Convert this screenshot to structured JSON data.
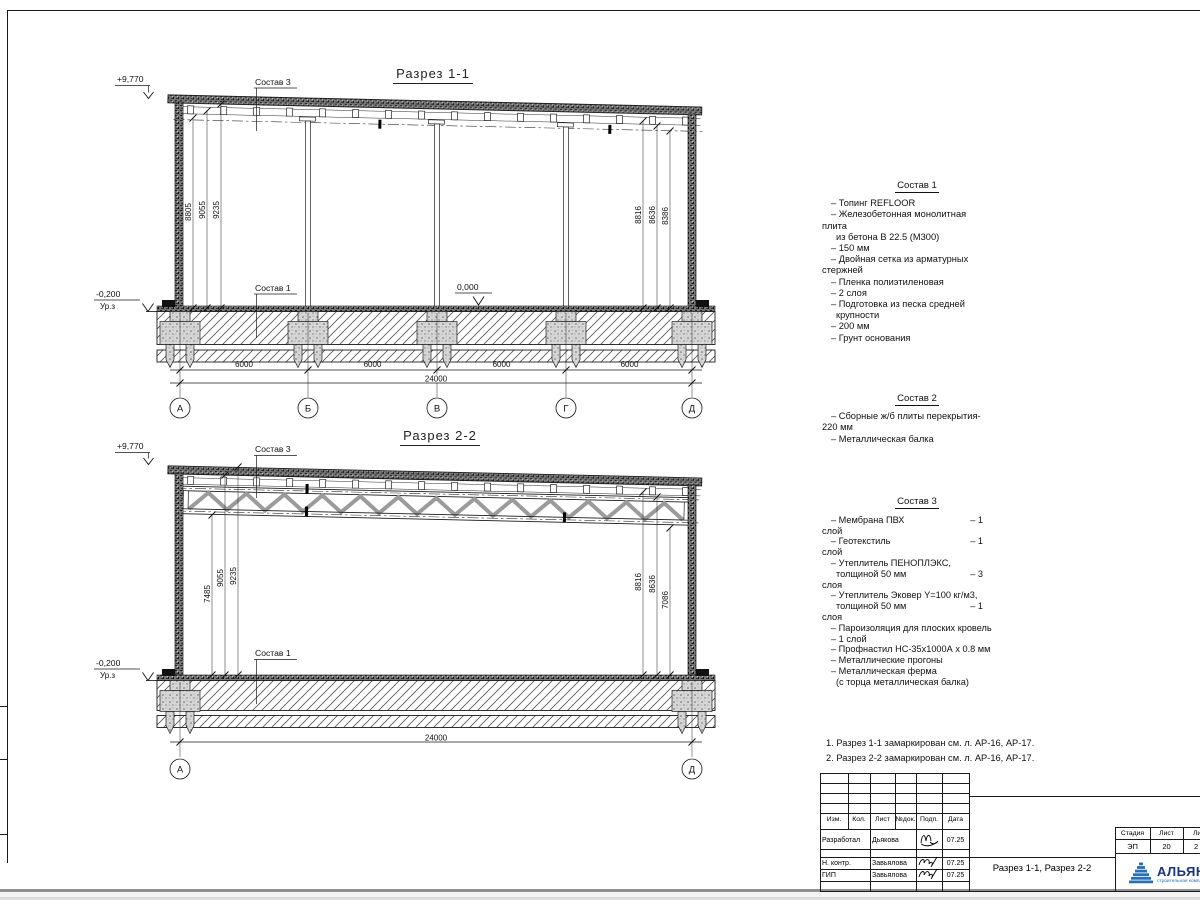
{
  "sections": {
    "s1": {
      "title": "Разрез 1-1",
      "elev_top": "+9,770",
      "elev_zero": "0,000",
      "elev_ground": "-0,200",
      "ground_label": "Ур.з",
      "leader_roof": "Состав 3",
      "leader_floor": "Состав 1",
      "dims_left": [
        "8805",
        "9055",
        "9235"
      ],
      "dims_right": [
        "8816",
        "8636",
        "8386"
      ],
      "dims_span": [
        "6000",
        "6000",
        "6000",
        "6000"
      ],
      "dim_total": "24000",
      "axes": [
        "А",
        "Б",
        "В",
        "Г",
        "Д"
      ]
    },
    "s2": {
      "title": "Разрез 2-2",
      "elev_top": "+9,770",
      "elev_ground": "-0,200",
      "ground_label": "Ур.з",
      "leader_roof": "Состав 3",
      "leader_floor": "Состав 1",
      "dims_left": [
        "7485",
        "9055",
        "9235"
      ],
      "dims_right": [
        "8816",
        "8636",
        "7086"
      ],
      "dim_total": "24000",
      "axes": [
        "А",
        "Д"
      ]
    }
  },
  "compositions": [
    {
      "title": "Состав 1",
      "lines": [
        {
          "t": "– Топинг REFLOOR"
        },
        {
          "t": "– Железобетонная  монолитная"
        },
        {
          "t": "плита",
          "i": "c"
        },
        {
          "t": "из бетона В 22.5 (М300)",
          "i": "d"
        },
        {
          "t": "– 150 мм"
        },
        {
          "t": "– Двойная сетка из арматурных"
        },
        {
          "t": "стержней",
          "i": "c"
        },
        {
          "t": "– Пленка полиэтиленовая"
        },
        {
          "t": "–  2 слоя"
        },
        {
          "t": "– Подготовка из песка средней"
        },
        {
          "t": "крупности",
          "i": "d"
        },
        {
          "t": "– 200 мм"
        },
        {
          "t": "– Грунт основания"
        }
      ]
    },
    {
      "title": "Состав 2",
      "lines": [
        {
          "t": "– Сборные ж/б плиты перекрытия-"
        },
        {
          "t": "220 мм",
          "i": "c"
        },
        {
          "t": "– Металлическая балка"
        }
      ]
    },
    {
      "title": "Состав 3",
      "lines": [
        {
          "t": "– Мембрана ПВХ",
          "v": "– 1"
        },
        {
          "t": "слой",
          "i": "c"
        },
        {
          "t": "– Геотекстиль",
          "v": "– 1"
        },
        {
          "t": "слой",
          "i": "c"
        },
        {
          "t": "– Утеплитель ПЕНОПЛЭКС,"
        },
        {
          "t": "толщиной 50 мм",
          "i": "d",
          "v": "– 3"
        },
        {
          "t": "слоя",
          "i": "c"
        },
        {
          "t": "– Утеплитель Эковер Y=100 кг/м3,"
        },
        {
          "t": "толщиной 50 мм",
          "i": "d",
          "v": "– 1"
        },
        {
          "t": "слоя",
          "i": "c"
        },
        {
          "t": "– Пароизоляция для плоских кровель"
        },
        {
          "t": "– 1 слой"
        },
        {
          "t": "– Профнастил НС-35х1000А х 0.8 мм"
        },
        {
          "t": "– Металлические прогоны"
        },
        {
          "t": "– Металлическая ферма"
        },
        {
          "t": "(с торца металлическая балка)",
          "i": "d"
        }
      ]
    }
  ],
  "notes": [
    "1. Разрез 1-1 замаркирован см. л. АР-16, АР-17.",
    "2. Разрез 2-2 замаркирован см. л. АР-16, АР-17."
  ],
  "titleblock": {
    "headers": [
      "Изм.",
      "Кол.",
      "Лист",
      "№док.",
      "Подп.",
      "Дата"
    ],
    "rows": [
      {
        "role": "Разработал",
        "name": "Дьякова",
        "date": "07.25"
      },
      {
        "role": "Н. контр.",
        "name": "Завьялова",
        "date": "07.25"
      },
      {
        "role": "ГИП",
        "name": "Завьялова",
        "date": "07.25"
      }
    ],
    "doc_title": "Разрез 1-1, Разрез 2-2",
    "stage_label": "Стадия",
    "stage": "ЭП",
    "sheet_label": "Лист",
    "sheet": "20",
    "sheets_label": "Листов",
    "sheets": "2",
    "logo": {
      "name": "АЛЬЯНС",
      "tagline": "строительная компания",
      "accent": "#2a6fb5",
      "text_color": "#16367e"
    }
  }
}
